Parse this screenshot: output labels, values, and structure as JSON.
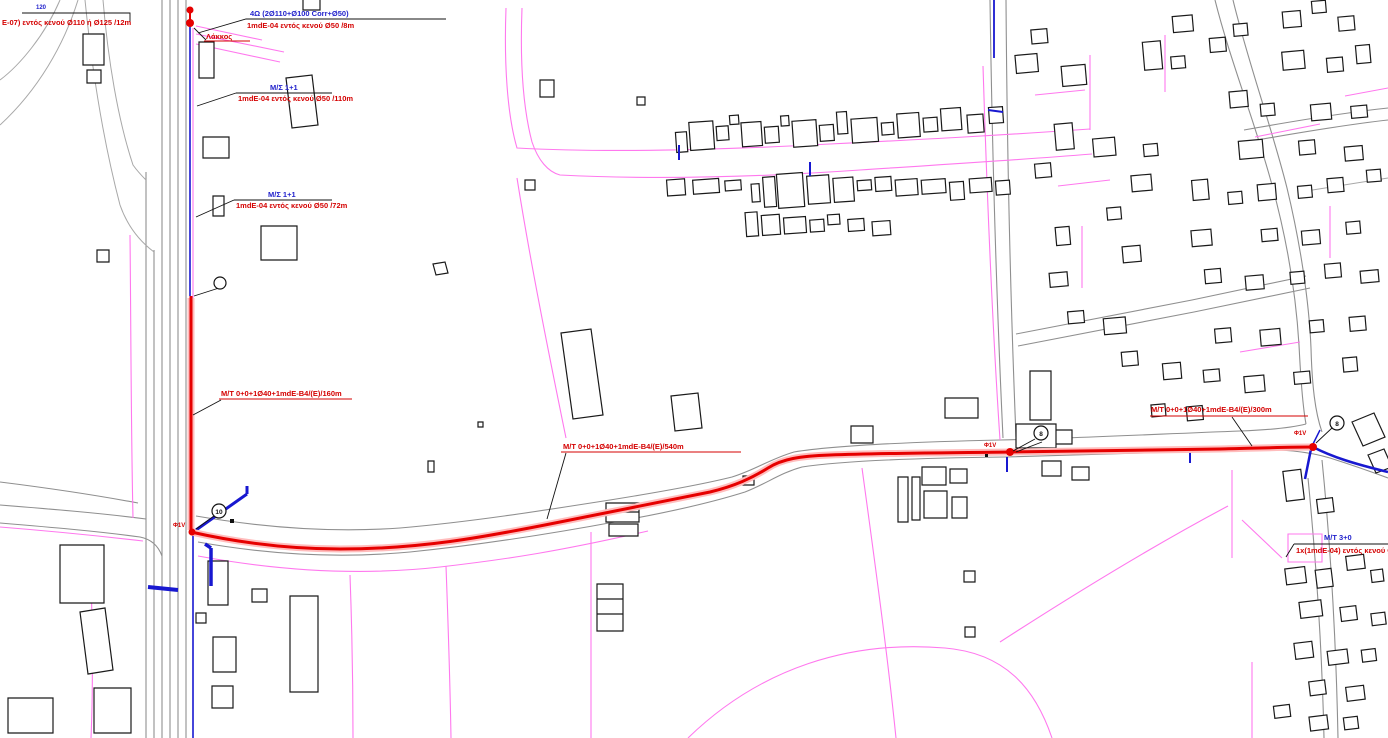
{
  "map": {
    "type": "utility-network-cadastral-plan",
    "colors": {
      "route_red": "#e60000",
      "route_glow": "#ffbdbd",
      "cable_blue": "#1818d0",
      "parcel_pink": "#ff78ee",
      "road_gray": "#8f8f8f",
      "building_black": "#1a1a1a",
      "text_red": "#d40000",
      "text_blue": "#2222cc"
    },
    "labels": {
      "top_left_distance": "120",
      "top_left_red": "Ε-07) εντός κενού Ø110 ή Ø125 /12m",
      "top_duct_blue": "4Ω (2Ø110+Ø100 Corr+Ø50)",
      "top_duct_red": "1mdE-04 εντός κενού Ø50 /8m",
      "pit": "Λάκκος",
      "ms1_title": "M/Σ 1+1",
      "ms1_sub": "1mdE-04 εντός κενού Ø50 /110m",
      "ms2_title": "M/Σ 1+1",
      "ms2_sub": "1mdE-04 εντός κενού Ø50 /72m",
      "route_left": "M/T 0+0+1Ø40+1mdE-B4/(E)/160m",
      "route_center": "M/T 0+0+1Ø40+1mdE-B4/(E)/540m",
      "route_right": "M/T 0+0+1Ø40+1mdE-B4/(E)/300m",
      "ms3_title": "M/T 3+0",
      "ms3_sub": "1x(1mdE-04) εντός κενού Ø"
    },
    "nodes": {
      "left": "Φ1V",
      "mid": "Φ1V",
      "right": "Φ1V"
    },
    "manholes": {
      "left": "10",
      "mid": "8",
      "right": "8"
    }
  }
}
